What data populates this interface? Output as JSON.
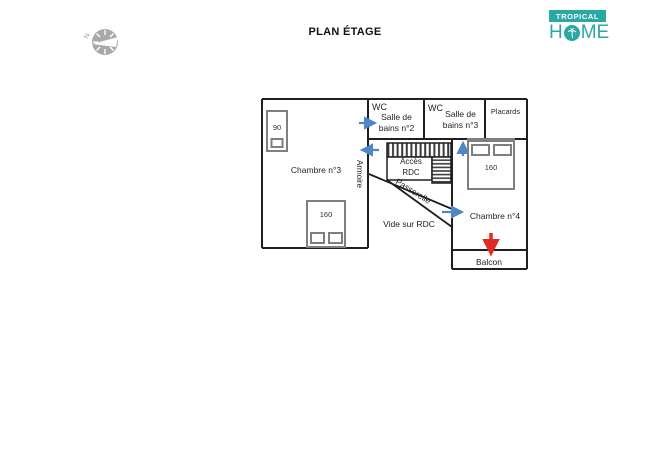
{
  "title": "PLAN ÉTAGE",
  "logo": {
    "brand_top": "TROPICAL",
    "home_h": "H",
    "home_me": "ME",
    "teal": "#2ca8a4"
  },
  "compass": {
    "north_label": "N"
  },
  "plan": {
    "rooms": {
      "chambre3": "Chambre n°3",
      "chambre4": "Chambre n°4",
      "bains2": {
        "wc": "WC",
        "line1": "Salle de",
        "line2": "bains n°2"
      },
      "bains3": {
        "wc": "WC",
        "line1": "Salle de",
        "line2": "bains n°3"
      },
      "placards": "Placards",
      "armoire": "Armoire",
      "acces_line1": "Accès",
      "acces_line2": "RDC",
      "passerelle": "Passerelle",
      "vide": "Vide sur RDC",
      "balcon": "Balcon"
    },
    "beds": {
      "single": "90",
      "double1": "160",
      "double2": "160"
    },
    "colors": {
      "wall": "#1f1f1f",
      "bed_gray": "#7f7f7f",
      "arrow_blue": "#4f86c6",
      "arrow_red": "#e02b20",
      "compass_gray": "#a9a9a9"
    }
  }
}
